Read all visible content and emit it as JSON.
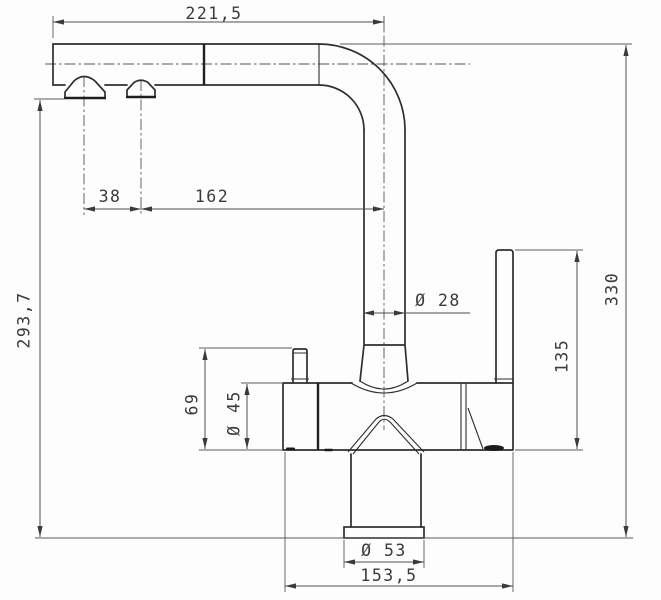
{
  "drawing": {
    "kind": "technical-dimension-drawing",
    "subject": "kitchen-faucet-front-view",
    "colors": {
      "background": "#fdfdfd",
      "object_line": "#2e2e2e",
      "dimension_line": "#4f4f4f",
      "text": "#3a3a3a"
    },
    "dims": {
      "spout_reach": "221,5",
      "aerator_spacing": "38",
      "aerator_to_riser_axis": "162",
      "spout_outlet_height": "293,7",
      "spout_tube_diameter": "Ø 28",
      "total_height": "330",
      "handle_height": "135",
      "outlet_port_height": "69",
      "body_diameter": "Ø 45",
      "base_diameter": "Ø 53",
      "body_length": "153,5"
    }
  }
}
